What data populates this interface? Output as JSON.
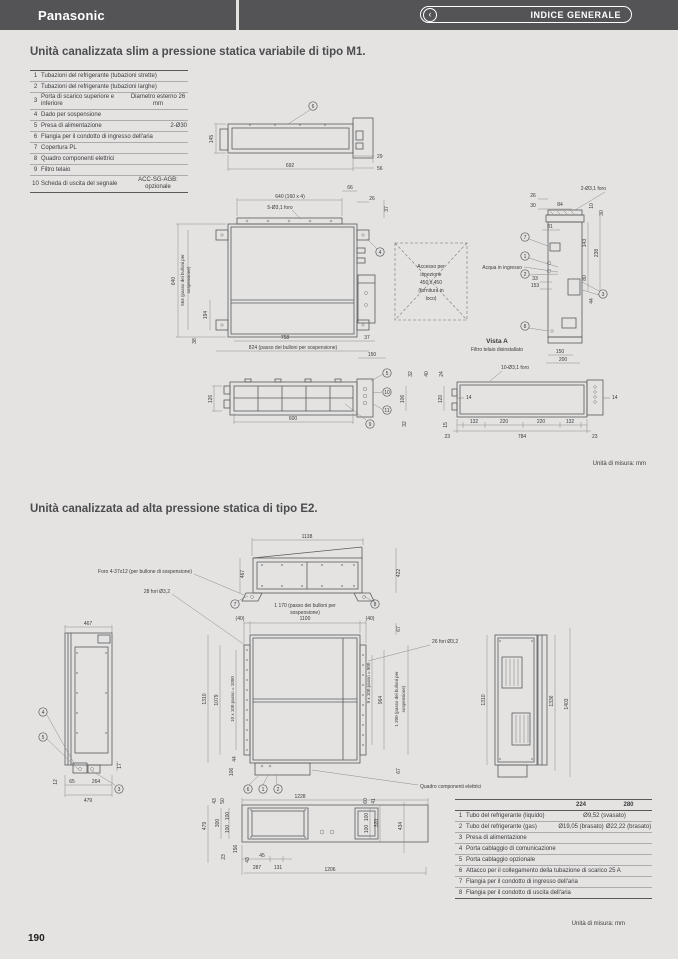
{
  "header": {
    "brand": "Panasonic",
    "nav_label": "INDICE GENERALE",
    "chevron": "‹"
  },
  "footer": {
    "page_number": "190"
  },
  "m1": {
    "title": "Unità canalizzata slim a pressione statica variabile di tipo M1.",
    "unit_note": "Unità di misura: mm",
    "parts": {
      "rows": [
        {
          "n": "1",
          "label": "Tubazioni del refrigerante (tubazioni strette)",
          "value": ""
        },
        {
          "n": "2",
          "label": "Tubazioni del refrigerante (tubazioni larghe)",
          "value": ""
        },
        {
          "n": "3",
          "label": "Porta di scarico superiore e inferiore",
          "value": "Diametro esterno 26 mm"
        },
        {
          "n": "4",
          "label": "Dado per sospensione",
          "value": ""
        },
        {
          "n": "5",
          "label": "Presa di alimentazione",
          "value": "2-Ø30"
        },
        {
          "n": "6",
          "label": "Flangia per il condotto di ingresso dell'aria",
          "value": ""
        },
        {
          "n": "7",
          "label": "Copertura PL",
          "value": ""
        },
        {
          "n": "8",
          "label": "Quadro componenti elettrici",
          "value": ""
        },
        {
          "n": "9",
          "label": "Filtro telaio",
          "value": ""
        },
        {
          "n": "10",
          "label": "Scheda di uscita del segnale",
          "value": "ACC-SG-AGB: opzionale"
        }
      ]
    },
    "front": {
      "b6": "6",
      "d145": "145",
      "d692": "692",
      "d29": "29",
      "d56": "56"
    },
    "plan": {
      "d640t": "640 (160 x 4)",
      "holes": "5-Ø3,1 foro",
      "d66": "66",
      "d26": "26",
      "d37r": "37",
      "d640": "640",
      "d564a": "564 (passo dei bulloni per",
      "d564b": "sospensione)",
      "d194": "194",
      "d38": "38",
      "d758": "758",
      "d37b": "37",
      "d824": "824 (passo dei bulloni per sospensione)",
      "d150": "150",
      "b4": "4"
    },
    "inspection": {
      "l1": "Accesso per",
      "l2": "ispezione",
      "l3": "450 x 450",
      "l4": "(fornitura in",
      "l5": "loco)"
    },
    "vista": {
      "caption": "Vista A",
      "subcaption": "Filtro telaio disinstallato",
      "holes": "2-Ø3,1 foro",
      "acqua": "Acqua in ingresso",
      "d26": "26",
      "d30": "30",
      "d84": "84",
      "d10": "10",
      "d30b": "30",
      "d81": "81",
      "d143": "143",
      "d238": "238",
      "d80": "80",
      "d33": "33",
      "d153": "153",
      "d44": "44",
      "d150": "150",
      "d200": "200",
      "b7": "7",
      "b1": "1",
      "b2": "2",
      "b3": "3",
      "b8": "8"
    },
    "bfront": {
      "d126": "126",
      "d600": "600",
      "b5": "5",
      "b10": "10",
      "b11": "11",
      "b9": "9"
    },
    "bside": {
      "holes": "10-Ø3,1 foro",
      "d32": "32",
      "d40": "40",
      "d24": "24",
      "d106": "106",
      "d120": "120",
      "d32b": "32",
      "d15": "15",
      "d23l": "23",
      "d132l": "132",
      "d220l": "220",
      "d220r": "220",
      "d132r": "132",
      "d784": "784",
      "d23r": "23",
      "d14l": "14",
      "d14r": "14"
    }
  },
  "e2": {
    "title": "Unità canalizzata ad alta pressione statica di tipo E2.",
    "unit_note": "Unità di misura: mm",
    "ftop": {
      "d1138": "1138",
      "d422": "422",
      "d467": "467",
      "foro": "Foro 4-37x12 (per bullone di sospensione)",
      "fori28": "28 fori Ø3,2",
      "d1170a": "1 170 (passo dei bulloni per",
      "d1170b": "sospensione)",
      "b7": "7",
      "b8": "8"
    },
    "plan": {
      "d40l": "(40)",
      "d1100": "1100",
      "d40r": "(40)",
      "d67t": "67",
      "d1310": "1310",
      "d1079": "1079",
      "passo10": "10 x 100 passo = 1000",
      "passo9": "9 x 100 passo = 900",
      "d964": "964",
      "d1200a": "1 200 (passo dei bulloni per",
      "d1200b": "sospensione)",
      "fori26": "26 fori Ø3,2",
      "d44": "44",
      "d106": "106",
      "d67b": "67",
      "b6": "6",
      "b1": "1",
      "b2": "2",
      "quadro": "Quadro componenti elettrici"
    },
    "lside": {
      "d467": "467",
      "d17": "17",
      "d12": "12",
      "d65": "65",
      "d264": "264",
      "d479": "479",
      "b4": "4",
      "b5": "5",
      "b3": "3"
    },
    "rside": {
      "d1310": "1310",
      "d1336": "1336",
      "d1403": "1403"
    },
    "bottom": {
      "d1228": "1228",
      "d43": "43",
      "d50": "50",
      "d300": "300",
      "d100a": "100",
      "d100b": "100",
      "d479": "479",
      "d156": "156",
      "d23": "23",
      "d43b": "43",
      "d45": "45",
      "d287": "287",
      "d131": "131",
      "d1206": "1206",
      "d60": "60",
      "d41": "41",
      "d100c": "100",
      "d100d": "100",
      "d320": "320",
      "d434": "434"
    },
    "parts": {
      "c224": "224",
      "c280": "280",
      "rows": [
        {
          "n": "1",
          "label": "Tubo del refrigerante (liquido)",
          "v1": "Ø9,52 (svasato)"
        },
        {
          "n": "2",
          "label": "Tubo del refrigerante (gas)",
          "v1": "Ø19,05 (brasato)",
          "v2": "Ø22,22 (brasato)"
        },
        {
          "n": "3",
          "label": "Presa di alimentazione"
        },
        {
          "n": "4",
          "label": "Porta cablaggio di comunicazione"
        },
        {
          "n": "5",
          "label": "Porta cablaggio opzionale"
        },
        {
          "n": "6",
          "label": "Attacco per il collegamento della tubazione di scarico 25 A"
        },
        {
          "n": "7",
          "label": "Flangia per il condotto di ingresso dell'aria"
        },
        {
          "n": "8",
          "label": "Flangia per il condotto di uscita dell'aria"
        }
      ]
    }
  }
}
